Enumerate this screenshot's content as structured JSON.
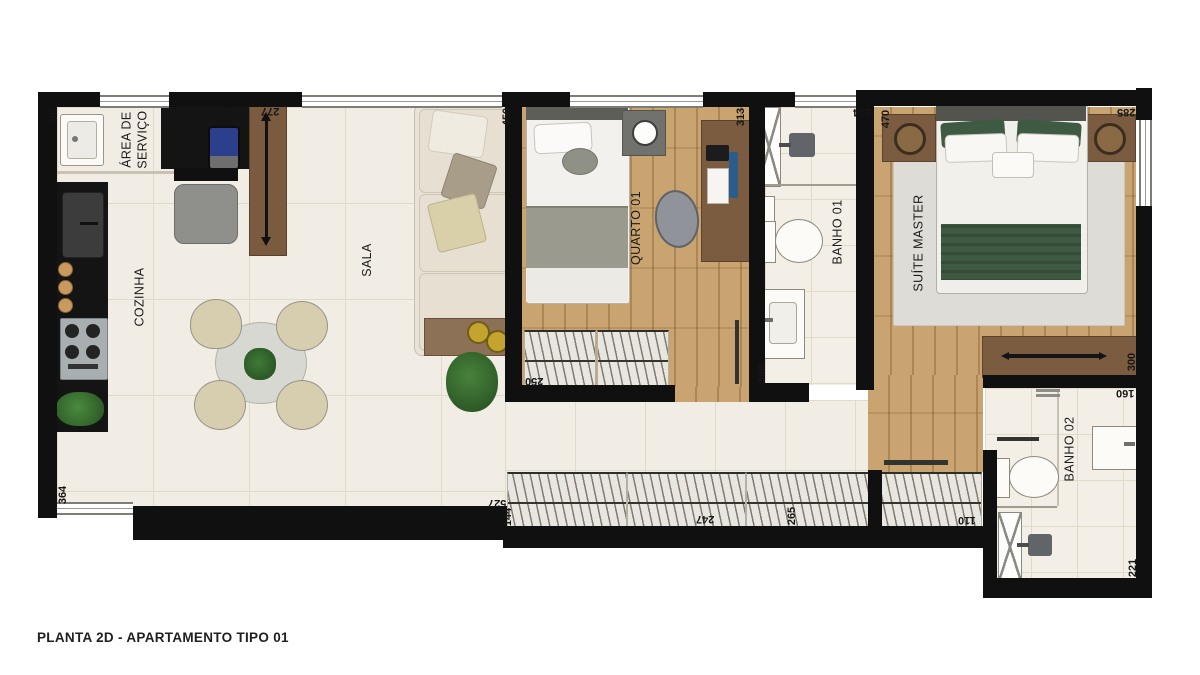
{
  "title": {
    "caption": "PLANTA 2D - APARTAMENTO TIPO 01"
  },
  "rooms": {
    "area_servico": {
      "line1": "ÁREA DE",
      "line2": "SERVIÇO"
    },
    "cozinha": {
      "label": "COZINHA"
    },
    "sala": {
      "label": "SALA"
    },
    "quarto01": {
      "label": "QUARTO 01"
    },
    "banho01": {
      "label": "BANHO 01"
    },
    "suite": {
      "label": "SUÍTE MASTER"
    },
    "banho02": {
      "label": "BANHO 02"
    }
  },
  "dimensions": {
    "d90": "90",
    "d220": "220",
    "d277": "277",
    "d450": "450",
    "d313": "313",
    "d124": "124",
    "d470": "470",
    "d285": "285",
    "d364": "364",
    "d250": "250",
    "d308": "308",
    "d527": "527",
    "d144": "144",
    "d247": "247",
    "d265": "265",
    "d110": "110",
    "d300": "300",
    "d160": "160",
    "d221": "221"
  },
  "colors": {
    "wall": "#101010",
    "tile_floor": "#f2ede4",
    "wood_floor": "#c59d66",
    "furniture_wood": "#7c5c40",
    "bed_green": "#3e5a43",
    "rug_gray": "#dedcd6",
    "counter_black": "#141414"
  }
}
